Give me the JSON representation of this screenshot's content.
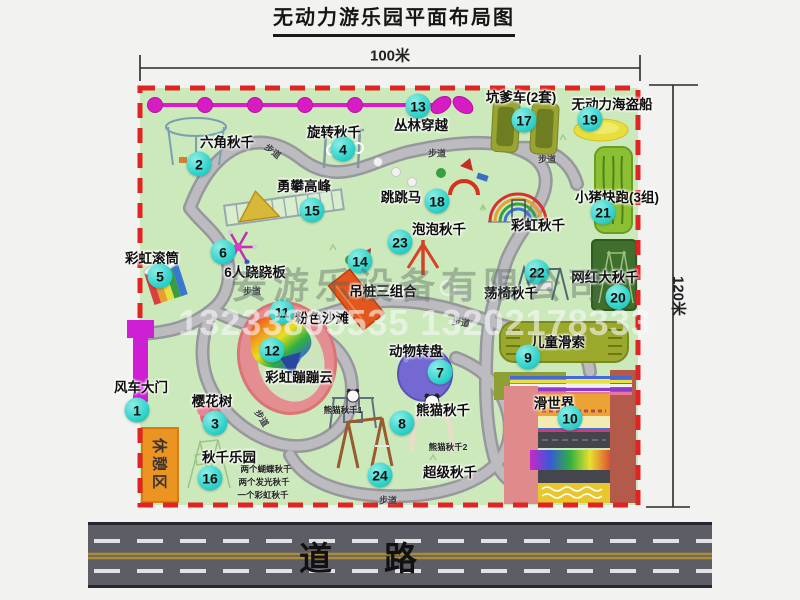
{
  "title": "无动力游乐园平面布局图",
  "dimensions": {
    "width": "100米",
    "height": "120米"
  },
  "road": {
    "label": "道路"
  },
  "watermark": {
    "company": "安游乐设备有限公司",
    "phones": "13233805535 13202178333"
  },
  "extras": {
    "rest_area": "休憩区",
    "rainbow_swing": "彩虹秋千"
  },
  "colors": {
    "map_green": "#cbe9bb",
    "border_red": "#e02423",
    "marker_teal": "#2fd2ca",
    "chain_magenta": "#e318c9",
    "road_gray": "#5d5d66",
    "rest_orange": "#eb9422"
  },
  "features": [
    {
      "n": "1",
      "label": "风车大门",
      "cx": 137,
      "cy": 410,
      "lx": 141,
      "ly": 386
    },
    {
      "n": "2",
      "label": "六角秋千",
      "cx": 199,
      "cy": 164,
      "lx": 227,
      "ly": 141
    },
    {
      "n": "3",
      "label": "樱花树",
      "cx": 215,
      "cy": 423,
      "lx": 212,
      "ly": 400
    },
    {
      "n": "4",
      "label": "旋转秋千",
      "cx": 343,
      "cy": 149,
      "lx": 334,
      "ly": 131
    },
    {
      "n": "5",
      "label": "彩虹滚筒",
      "cx": 160,
      "cy": 276,
      "lx": 152,
      "ly": 257
    },
    {
      "n": "6",
      "label": "6人跷跷板",
      "cx": 223,
      "cy": 252,
      "lx": 255,
      "ly": 271
    },
    {
      "n": "7",
      "label": "动物转盘",
      "cx": 440,
      "cy": 372,
      "lx": 416,
      "ly": 350
    },
    {
      "n": "8",
      "label": "熊猫秋千",
      "cx": 402,
      "cy": 423,
      "lx": 443,
      "ly": 409
    },
    {
      "n": "9",
      "label": "儿童滑索",
      "cx": 528,
      "cy": 357,
      "lx": 558,
      "ly": 341
    },
    {
      "n": "10",
      "label": "滑世界",
      "cx": 570,
      "cy": 418,
      "lx": 554,
      "ly": 402
    },
    {
      "n": "11",
      "label": "粉色沙滩",
      "cx": 282,
      "cy": 312,
      "lx": 322,
      "ly": 317
    },
    {
      "n": "12",
      "label": "彩虹蹦蹦云",
      "cx": 272,
      "cy": 350,
      "lx": 299,
      "ly": 376
    },
    {
      "n": "13",
      "label": "丛林穿越",
      "cx": 418,
      "cy": 106,
      "lx": 421,
      "ly": 124
    },
    {
      "n": "14",
      "label": "吊桩三组合",
      "cx": 360,
      "cy": 261,
      "lx": 383,
      "ly": 290
    },
    {
      "n": "15",
      "label": "勇攀高峰",
      "cx": 312,
      "cy": 210,
      "lx": 304,
      "ly": 185
    },
    {
      "n": "16",
      "label": "秋千乐园",
      "cx": 210,
      "cy": 478,
      "lx": 229,
      "ly": 456
    },
    {
      "n": "17",
      "label": "坑爹车(2套)",
      "cx": 524,
      "cy": 120,
      "lx": 521,
      "ly": 96
    },
    {
      "n": "18",
      "label": "跳跳马",
      "cx": 437,
      "cy": 201,
      "lx": 401,
      "ly": 196
    },
    {
      "n": "19",
      "label": "无动力海盗船",
      "cx": 590,
      "cy": 119,
      "lx": 612,
      "ly": 103
    },
    {
      "n": "20",
      "label": "网红大秋千",
      "cx": 618,
      "cy": 297,
      "lx": 605,
      "ly": 276
    },
    {
      "n": "21",
      "label": "小猪快跑(3组)",
      "cx": 603,
      "cy": 212,
      "lx": 617,
      "ly": 196
    },
    {
      "n": "22",
      "label": "荡椅秋千",
      "cx": 537,
      "cy": 272,
      "lx": 511,
      "ly": 292
    },
    {
      "n": "23",
      "label": "泡泡秋千",
      "cx": 400,
      "cy": 242,
      "lx": 439,
      "ly": 228
    },
    {
      "n": "24",
      "label": "超级秋千",
      "cx": 380,
      "cy": 475,
      "lx": 450,
      "ly": 471
    },
    {
      "n": "",
      "label": "彩虹秋千",
      "cx": 0,
      "cy": 0,
      "lx": 538,
      "ly": 224
    }
  ],
  "walkway_labels": [
    {
      "text": "步道",
      "x": 273,
      "y": 151,
      "rot": 38
    },
    {
      "text": "步道",
      "x": 437,
      "y": 153,
      "rot": 0
    },
    {
      "text": "步道",
      "x": 547,
      "y": 159,
      "rot": 0
    },
    {
      "text": "步道",
      "x": 252,
      "y": 291,
      "rot": 0
    },
    {
      "text": "步道",
      "x": 461,
      "y": 322,
      "rot": 8
    },
    {
      "text": "步道",
      "x": 262,
      "y": 418,
      "rot": 58
    },
    {
      "text": "步道",
      "x": 388,
      "y": 500,
      "rot": 0
    }
  ],
  "sub_labels": [
    {
      "text": "熊猫秋千1",
      "x": 343,
      "y": 410
    },
    {
      "text": "熊猫秋千2",
      "x": 448,
      "y": 447
    },
    {
      "text": "两个蝴蝶秋千",
      "x": 266,
      "y": 469
    },
    {
      "text": "两个发光秋千",
      "x": 264,
      "y": 482
    },
    {
      "text": "一个彩虹秋千",
      "x": 263,
      "y": 495
    }
  ]
}
